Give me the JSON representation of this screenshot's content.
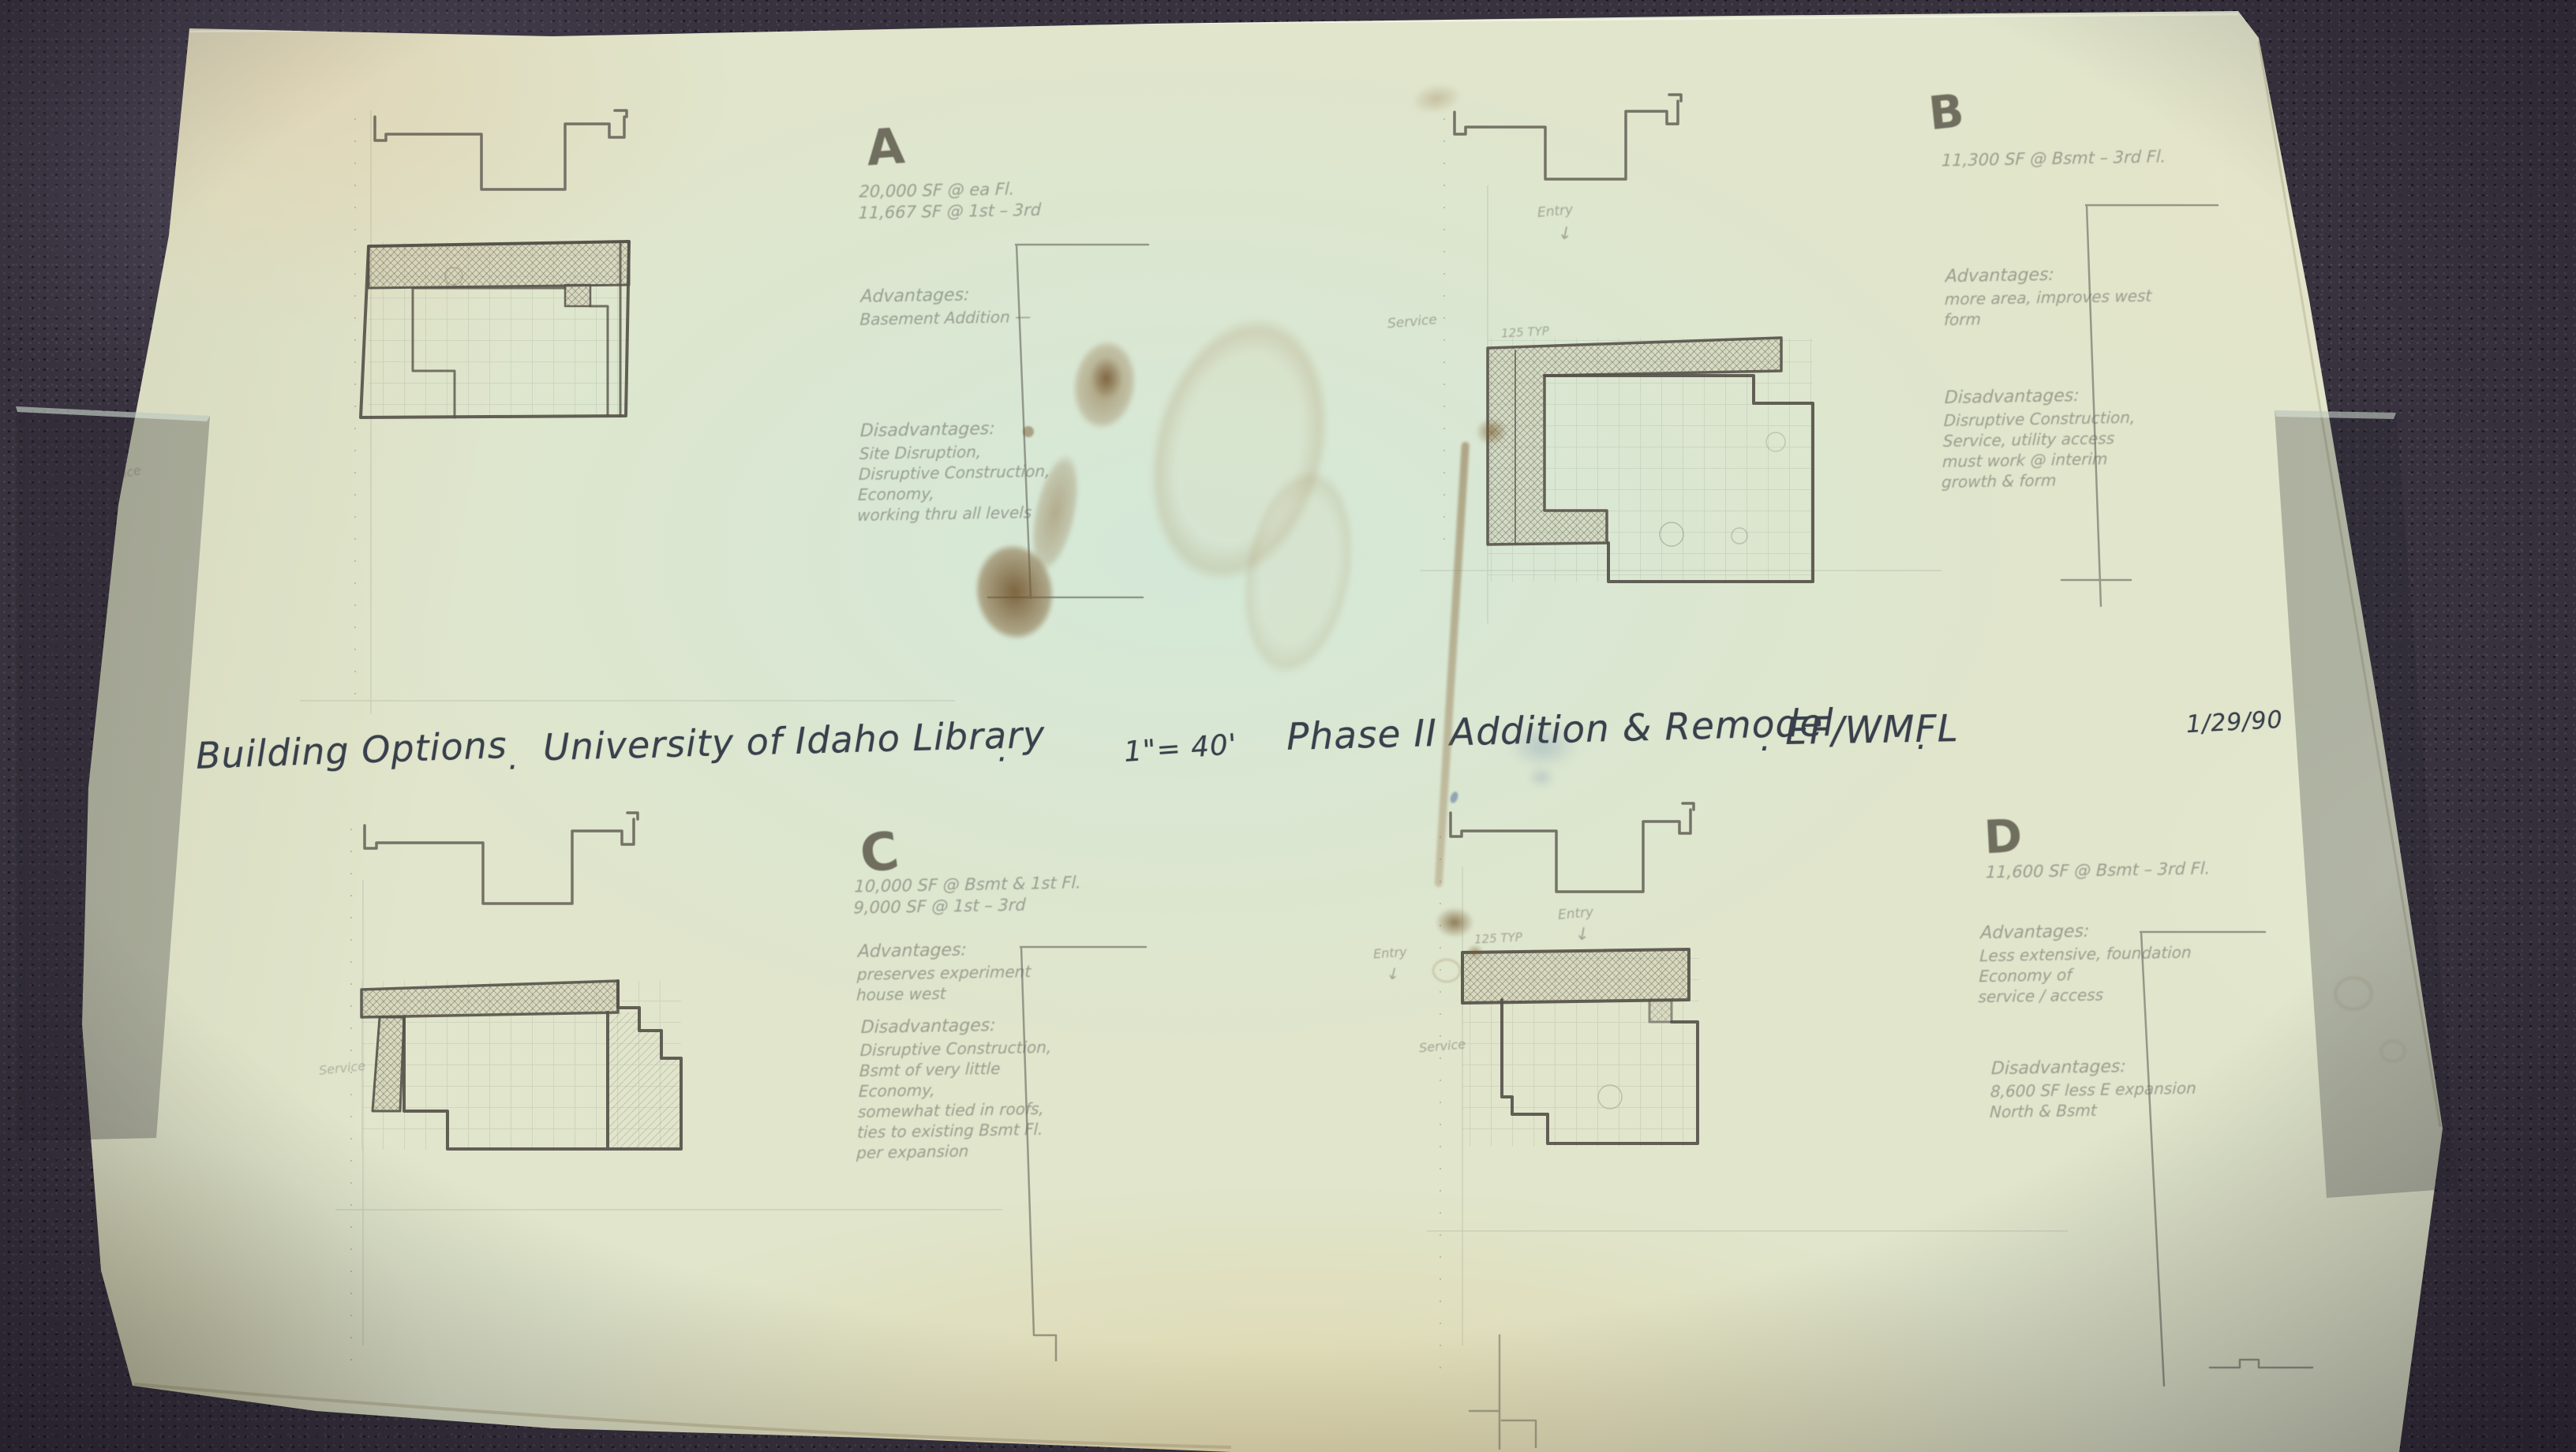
{
  "title": {
    "project": "Building Options",
    "dot1": "·",
    "client": "University of Idaho Library",
    "dot2": "·",
    "scale": "1\"= 40'",
    "phase": "Phase II Addition & Remodel",
    "dot3": "·",
    "firm": "EF/WMFL",
    "dot4": "·",
    "date": "1/29/90"
  },
  "headings": {
    "adv": "Advantages:",
    "dis": "Disadvantages:"
  },
  "options": {
    "a": {
      "label": "A",
      "area": [
        "20,000 SF @ ea Fl.",
        "11,667 SF @ 1st – 3rd"
      ],
      "adv": [
        "Basement Addition —"
      ],
      "dis": [
        "Site Disruption,",
        "Disruptive Construction,",
        "Economy,",
        "working thru all levels"
      ]
    },
    "b": {
      "label": "B",
      "area": [
        "11,300 SF @ Bsmt – 3rd Fl."
      ],
      "adv": [
        "more area, improves west",
        "form"
      ],
      "dis": [
        "Disruptive Construction,",
        "Service, utility access",
        "must work @ interim",
        "growth & form"
      ]
    },
    "c": {
      "label": "C",
      "area": [
        "10,000 SF @ Bsmt & 1st Fl.",
        "9,000 SF @ 1st – 3rd"
      ],
      "adv": [
        "preserves experiment",
        "house west"
      ],
      "dis": [
        "Disruptive Construction,",
        "Bsmt of very little",
        "Economy,",
        "somewhat tied in roofs,",
        "ties to existing Bsmt Fl.",
        "per expansion"
      ]
    },
    "d": {
      "label": "D",
      "area": [
        "11,600 SF @ Bsmt – 3rd Fl."
      ],
      "adv": [
        "Less extensive, foundation",
        "Economy of",
        "service / access"
      ],
      "dis": [
        "8,600 SF less E expansion",
        "North & Bsmt"
      ]
    }
  },
  "annotations": {
    "entry": "Entry",
    "arrow_down": "↓",
    "dim": "125 TYP",
    "service": "Service"
  },
  "colors": {
    "ink": "#39404c",
    "pencil": "#60625c",
    "paper_warm": "#e4dbb4",
    "paper_cool": "#dce8dc",
    "counter": "#38323f",
    "stain_brown": "#6d4e26"
  }
}
